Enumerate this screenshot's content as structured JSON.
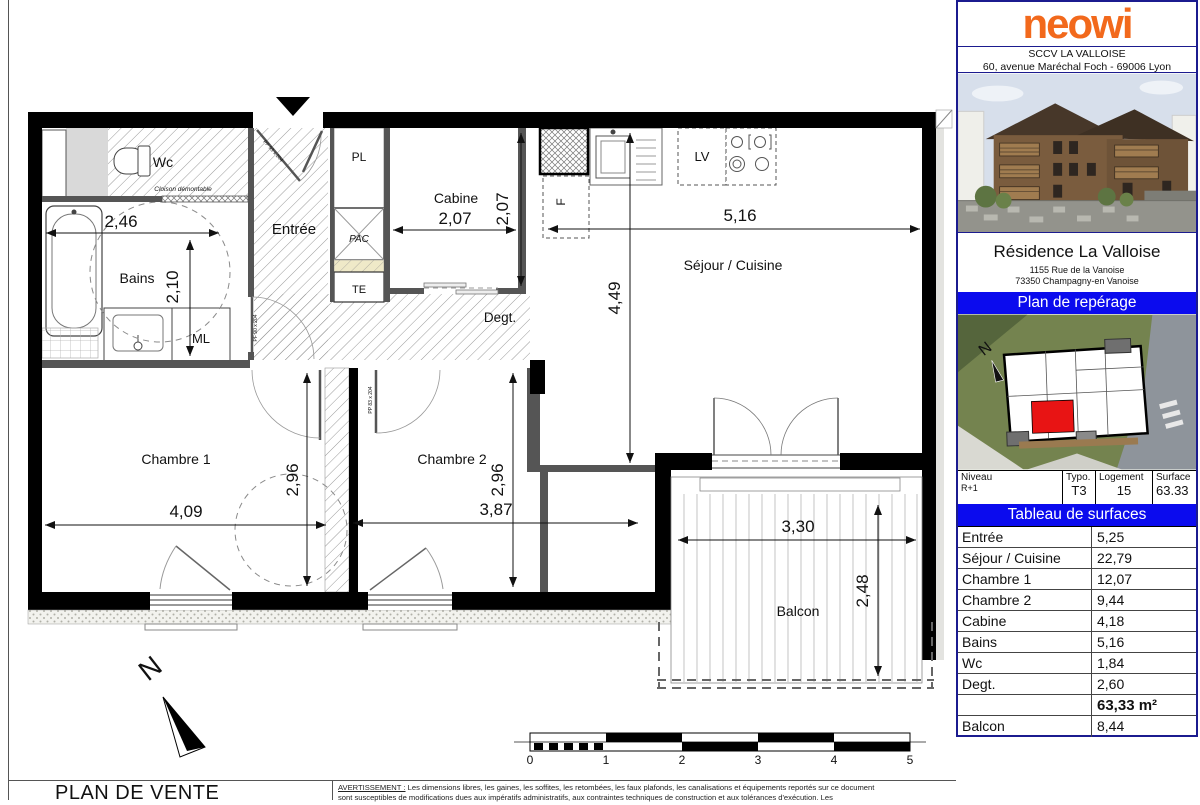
{
  "colors": {
    "accent_blue": "#0b0bee",
    "logo_orange": "#f2691c",
    "unit_red": "#e81414",
    "frame_navy": "#1b1b8f"
  },
  "title_block": {
    "logo": "neowi",
    "company": "SCCV LA VALLOISE",
    "company_address": "60, avenue Maréchal Foch - 69006 Lyon",
    "residence_name": "Résidence La Valloise",
    "residence_address_line1": "1155 Rue de la Vanoise",
    "residence_address_line2": "73350 Champagny-en Vanoise",
    "plan_reperage_title": "Plan de repérage"
  },
  "unit_info": {
    "niveau_label": "Niveau",
    "niveau_value": "R+1",
    "typo_label": "Typo.",
    "typo_value": "T3",
    "logement_label": "Logement",
    "logement_value": "15",
    "surface_label": "Surface",
    "surface_value": "63.33"
  },
  "surface_table": {
    "title": "Tableau de surfaces",
    "rows": [
      {
        "label": "Entrée",
        "value": "5,25"
      },
      {
        "label": "Séjour / Cuisine",
        "value": "22,79"
      },
      {
        "label": "Chambre 1",
        "value": "12,07"
      },
      {
        "label": "Chambre 2",
        "value": "9,44"
      },
      {
        "label": "Cabine",
        "value": "4,18"
      },
      {
        "label": "Bains",
        "value": "5,16"
      },
      {
        "label": "Wc",
        "value": "1,84"
      },
      {
        "label": "Degt.",
        "value": "2,60"
      },
      {
        "label": "",
        "value": "63,33 m²"
      },
      {
        "label": "Balcon",
        "value": "8,44"
      }
    ]
  },
  "floor_plan": {
    "rooms": {
      "wc": "Wc",
      "bains": "Bains",
      "entree": "Entrée",
      "cabine": "Cabine",
      "sejour": "Séjour / Cuisine",
      "degt": "Degt.",
      "chambre1": "Chambre 1",
      "chambre2": "Chambre 2",
      "balcon": "Balcon"
    },
    "fixtures": {
      "pl": "PL",
      "pac": "PAC",
      "te": "TE",
      "ml": "ML",
      "lv": "LV",
      "f": "F"
    },
    "dims": {
      "bains_width": "2,46",
      "bains_height": "2,10",
      "cabine_width": "2,07",
      "cabine_height": "2,07",
      "sejour_width": "5,16",
      "sejour_height": "4,49",
      "chambre1_width": "4,09",
      "chambre1_height": "2,96",
      "chambre2_width": "3,87",
      "chambre2_height": "2,96",
      "balcon_width": "3,30",
      "balcon_height": "2,48"
    },
    "annotations": {
      "cloison": "Cloison démontable",
      "door_entree": "PP 93 x 204",
      "door_bains": "PF 90 x 204",
      "door_chambre2": "PP 83 x 204",
      "north": "N"
    }
  },
  "scale_bar": {
    "ticks": [
      "0",
      "1",
      "2",
      "3",
      "4",
      "5"
    ]
  },
  "footer": {
    "plan_title": "PLAN DE VENTE",
    "warning_label": "AVERTISSEMENT :",
    "warning_line1": "Les dimensions libres, les gaines, les soffites, les retombées, les faux plafonds, les canalisations et équipements reportés sur ce document",
    "warning_line2": "sont susceptibles de modifications dues aux impératifs administratifs, aux contraintes techniques de construction et aux tolérances d'exécution. Les"
  }
}
